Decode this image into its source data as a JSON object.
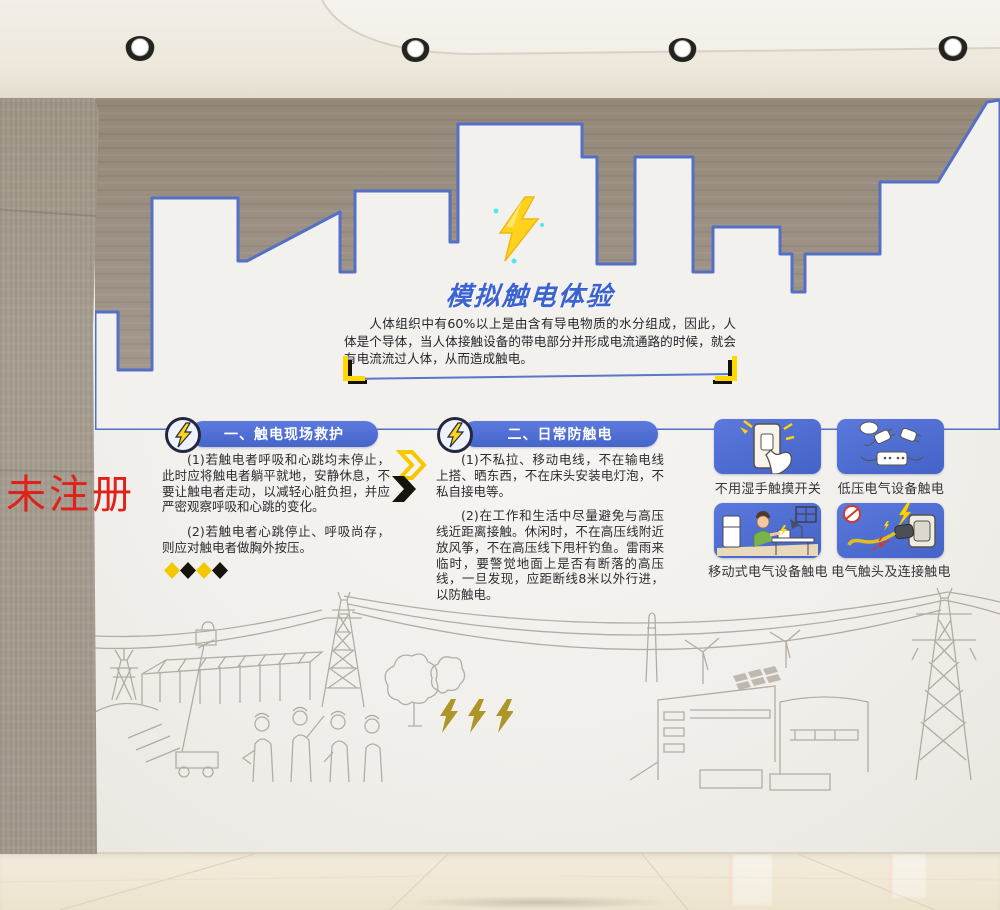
{
  "scene": {
    "watermark": "未注册",
    "spotlights": 4
  },
  "poster": {
    "title": "模拟触电体验",
    "intro": "人体组织中有60%以上是由含有导电物质的水分组成，因此，人体是个导体，当人体接触设备的带电部分并形成电流通路的时候，就会有电流流过人体，从而造成触电。",
    "sections": [
      {
        "heading": "一、触电现场救护",
        "paragraphs": [
          "(1)若触电者呼吸和心跳均未停止，此时应将触电者躺平就地，安静休息，不要让触电者走动，以减轻心脏负担，并应严密观察呼吸和心跳的变化。",
          "(2)若触电者心跳停止、呼吸尚存，则应对触电者做胸外按压。"
        ]
      },
      {
        "heading": "二、日常防触电",
        "paragraphs": [
          "(1)不私拉、移动电线，不在输电线上搭、晒东西，不在床头安装电灯泡，不私自接电等。",
          "(2)在工作和生活中尽量避免与高压线近距离接触。休闲时，不在高压线附近放风筝，不在高压线下甩杆钓鱼。雷雨来临时，要警觉地面上是否有断落的高压线，一旦发现，应距断线8米以外行进，以防触电。"
        ]
      }
    ],
    "hazard_cards": [
      {
        "icon": "wet-hand-switch-icon",
        "label": "不用湿手触摸开关"
      },
      {
        "icon": "low-voltage-plugs-icon",
        "label": "低压电气设备触电"
      },
      {
        "icon": "portable-appliance-icon",
        "label": "移动式电气设备触电"
      },
      {
        "icon": "plug-socket-spark-icon",
        "label": "电气触头及连接触电"
      }
    ]
  },
  "kiosk": {
    "screen_title": "模拟触电体验教学系统",
    "front_label": "电感体验"
  },
  "colors": {
    "accent_blue": "#4a68cc",
    "title_blue": "#3c63d2",
    "skyline_outline_blue": "#5470c6",
    "bolt_yellow": "#ffd21e",
    "gold_text": "#ad9527",
    "panel_olive": "#b4a616",
    "watermark_red": "#e0201a"
  }
}
